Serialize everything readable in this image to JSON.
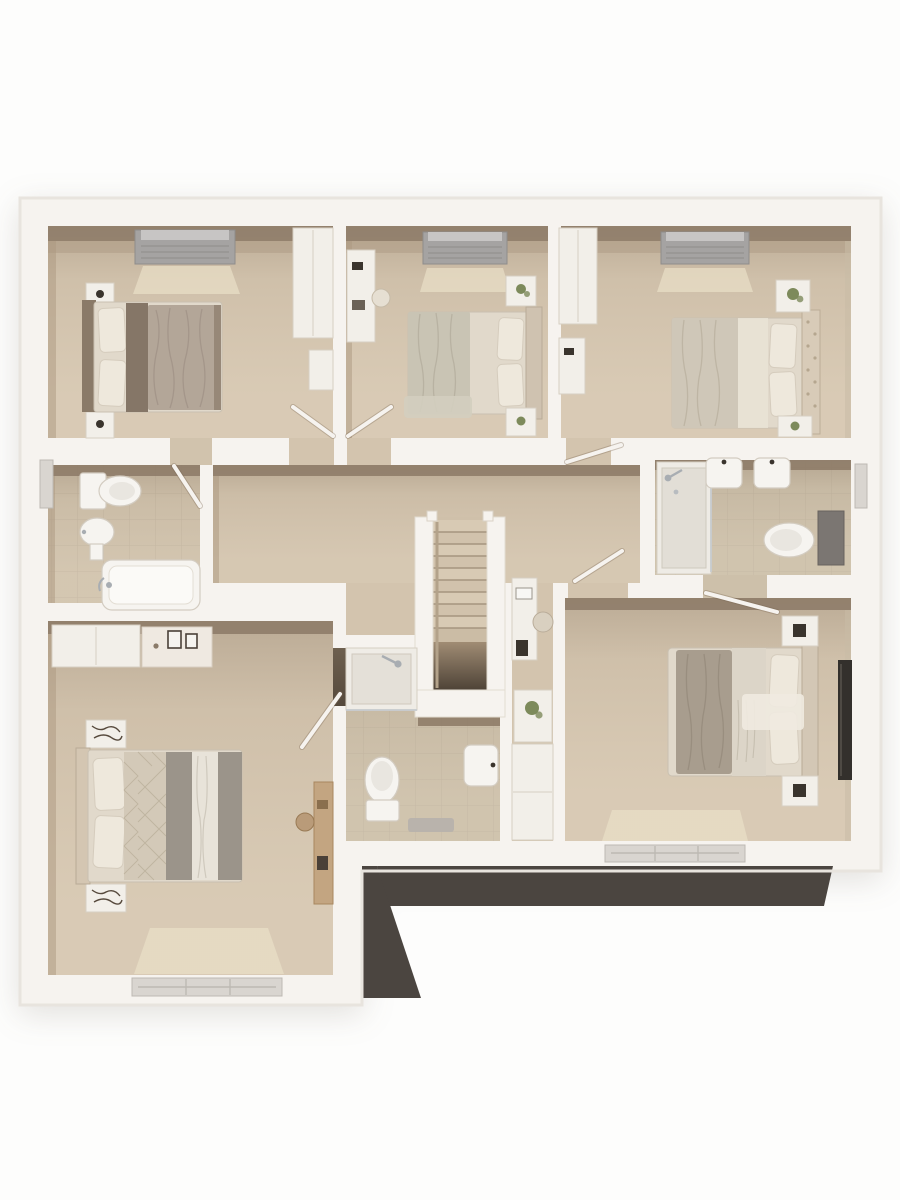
{
  "title": "3D dollhouse floor plan render — upper storey",
  "render_type": "architectural-3d-floor-plan",
  "palette": {
    "page-bg": "#fdfdfc",
    "wall": "#f6f3ef",
    "wall-edge": "#e5e1db",
    "floor": "#d6c7b1",
    "floor-hall": "#d3c4ae",
    "tile": "#cdc0aa",
    "tile-pink": "#d1c3ad",
    "grout": "#b7aa95",
    "face-dark": "#8d7b68",
    "face-mid": "#ab9780",
    "face-light": "#c9bba5",
    "roof-dark": "#4b4540",
    "furn-white": "#f2efe9",
    "furn-stroke": "#d7cfc2",
    "linen": "#e1d9cb",
    "pillow": "#eee8dc",
    "duvet-brown": "#b3a698",
    "duvet-runner": "#857667",
    "duvet-gray": "#9b948a",
    "headboard": "#cfc0ac",
    "wood": "#c3a581",
    "wood-dark": "#a8875f",
    "window-gray": "#a5a3a2",
    "window-light": "#d9d5d0",
    "lightpatch": "#eadfc8",
    "plant": "#7d8a5b",
    "chrome": "#a8adb2",
    "dark-item": "#3a342d",
    "tv-panel": "#33302c",
    "stair-dark": "#4e4337"
  },
  "plan": {
    "storey": "upper",
    "rooms": [
      {
        "name": "bedroom-1",
        "position": "top-left",
        "furniture": [
          "double-bed",
          "slatted-headboard",
          "nightstand-lamp-top",
          "nightstand-lamp-bottom",
          "wardrobe",
          "window-top"
        ]
      },
      {
        "name": "bedroom-2",
        "position": "top-middle",
        "furniture": [
          "double-bed",
          "desk",
          "desk-chair",
          "nightstand-plant-top",
          "nightstand-plant-bottom",
          "window-top"
        ]
      },
      {
        "name": "bedroom-3",
        "position": "top-right",
        "furniture": [
          "double-bed",
          "tufted-headboard",
          "wardrobe",
          "nightstand-plant-top",
          "nightstand-plant-bottom",
          "window-top"
        ]
      },
      {
        "name": "family-bathroom",
        "position": "middle-left",
        "furniture": [
          "toilet",
          "pedestal-basin",
          "bathtub",
          "window-left"
        ]
      },
      {
        "name": "landing",
        "position": "center",
        "furniture": [
          "staircase",
          "handrail",
          "study-desk",
          "desk-chair",
          "laptop",
          "tablet"
        ]
      },
      {
        "name": "en-suite-bathroom",
        "position": "middle-right",
        "furniture": [
          "shower-enclosure",
          "twin-wall-basins",
          "toilet",
          "cistern-panel",
          "window-right"
        ]
      },
      {
        "name": "shower-room",
        "position": "center-bottom",
        "furniture": [
          "shower-enclosure",
          "toilet",
          "wall-basin",
          "bath-mat"
        ]
      },
      {
        "name": "bedroom-4",
        "position": "bottom-left",
        "furniture": [
          "double-bed",
          "quilted-throw",
          "patterned-nightstand-top",
          "patterned-nightstand-bottom",
          "cupboard",
          "dresser-with-frames",
          "wood-desk",
          "chair",
          "window-bottom"
        ]
      },
      {
        "name": "bedroom-5",
        "position": "bottom-right",
        "furniture": [
          "double-bed",
          "nightstand-lamp-top",
          "nightstand-lamp-bottom",
          "tv-panel",
          "cabinet-nook",
          "plant",
          "window-bottom"
        ]
      }
    ],
    "doors": [
      "bedroom-1-door",
      "bedroom-2-door",
      "bedroom-3-door",
      "family-bathroom-door",
      "bedroom-4-door",
      "bedroom-5-door",
      "en-suite-door"
    ],
    "exterior": [
      "lower-roof-band-bottom-right",
      "wing-extension-bottom-left"
    ]
  }
}
